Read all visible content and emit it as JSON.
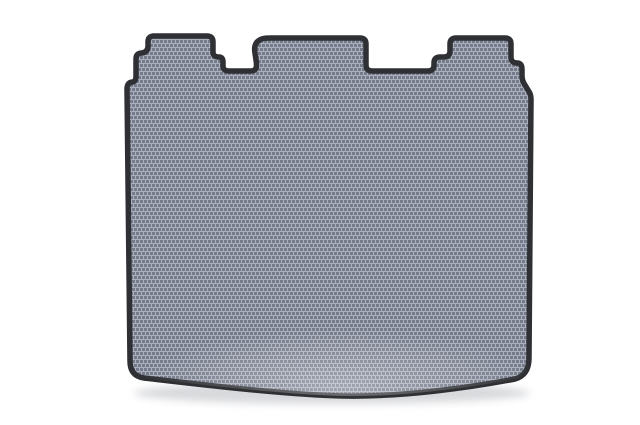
{
  "page": {
    "background_color": "#ffffff"
  },
  "product_photo": {
    "subject": "car-trunk-eva-mat",
    "texture_style": "honeycomb-basket-weave",
    "colors": {
      "texture_dark": "#767b8b",
      "texture_light": "#aab0bc",
      "trim": "#2e3034",
      "shadow": "#a7aab1",
      "highlight": "#ffffff"
    }
  }
}
